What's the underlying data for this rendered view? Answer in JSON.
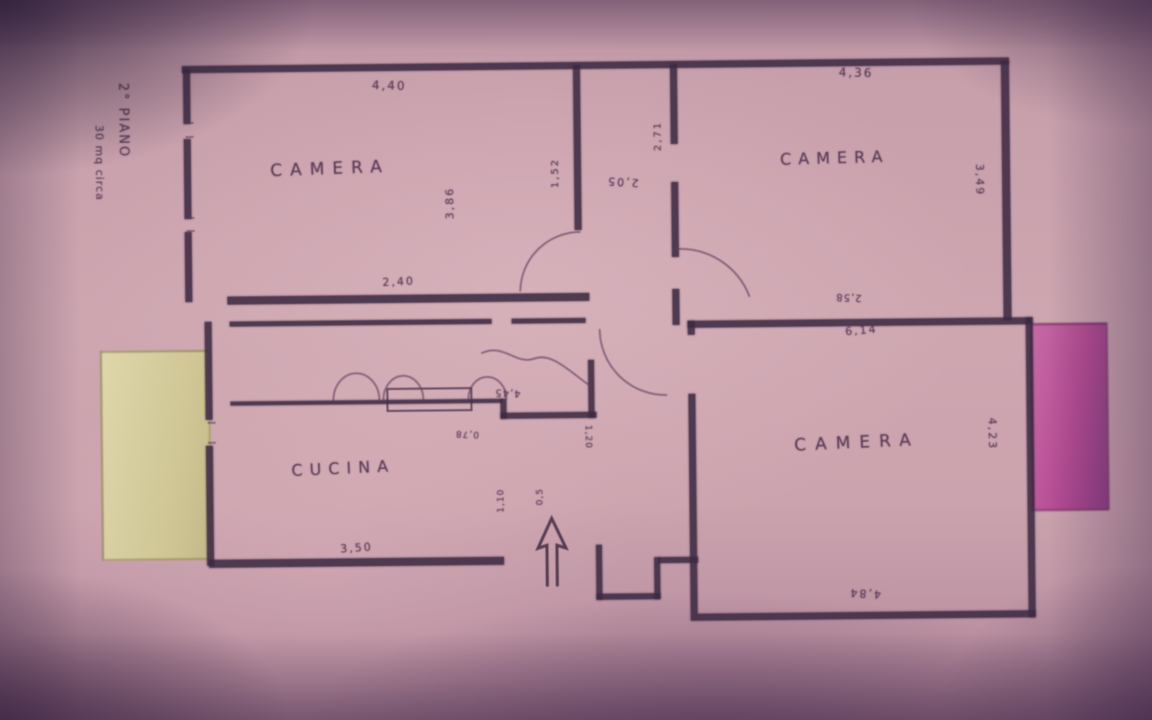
{
  "side_note": {
    "line1": "2° PIANO",
    "line2": "30 mq circa"
  },
  "rooms": {
    "camera_top_left": "CAMERA",
    "camera_top_right": "CAMERA",
    "camera_bottom_right": "CAMERA",
    "cucina": "CUCINA"
  },
  "dimensions": {
    "camera_tl_width": "4,40",
    "camera_tl_depth": "3,86",
    "camera_tr_width": "4,36",
    "camera_tr_height": "3,49",
    "hall_left": "1,52",
    "hall_mid": "2,05",
    "hall_right": "2,71",
    "corridor_width": "2,40",
    "cucina_width": "3,50",
    "camera_br_top_small": "2,58",
    "camera_br_width_top": "6,14",
    "camera_br_width_bottom": "4,84",
    "camera_br_height": "4,23",
    "hall_south": "4,45",
    "hall_small_a": "0,78",
    "hall_small_b": "1,20",
    "entry_a": "1,10",
    "entry_b": "0,5"
  },
  "colors": {
    "paper": "#cda6b0",
    "wall_ink": "#3e2a42",
    "pencil_ink": "#54364f",
    "balcony_left": "#d6cfa0",
    "balcony_right": "#b2498f"
  },
  "icons": {
    "entrance_arrow": "hollow-up-arrow"
  }
}
